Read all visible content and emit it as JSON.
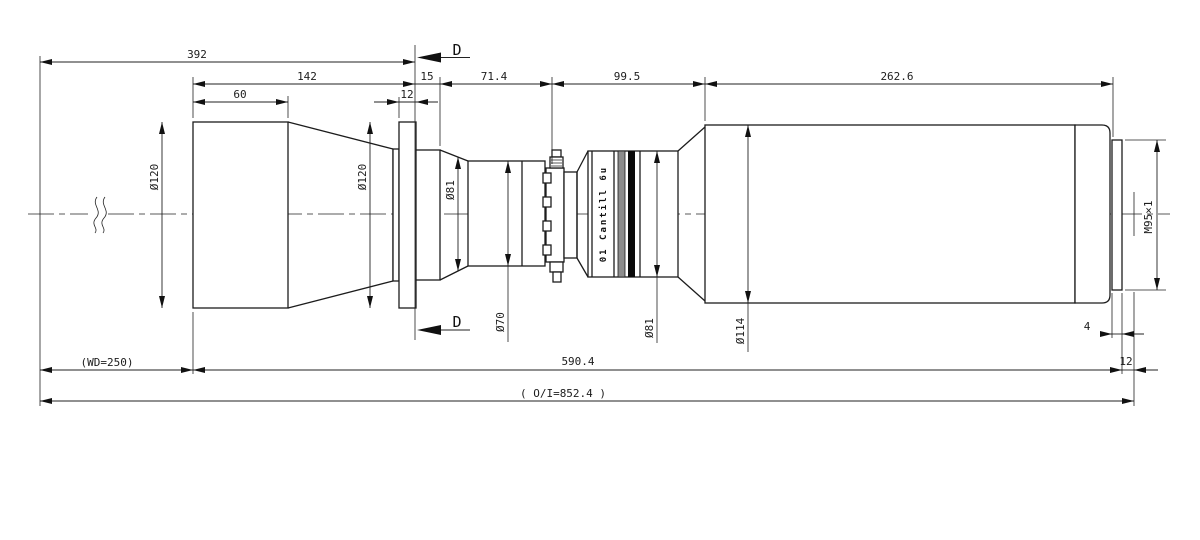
{
  "drawing": {
    "type": "technical-drawing",
    "subject": "lens mechanical outline drawing",
    "section_marker": "D",
    "dims_top": {
      "d392": "392",
      "d142": "142",
      "d60": "60",
      "d15": "15",
      "d12": "12",
      "d71_4": "71.4",
      "d99_5": "99.5",
      "d262_6": "262.6"
    },
    "dims_bottom": {
      "wd": "(WD=250)",
      "d590_4": "590.4",
      "d4": "4",
      "d12": "12",
      "oi": "( O/I=852.4 )"
    },
    "diameters": {
      "front": "Ø120",
      "flange": "Ø120",
      "cone81": "Ø81",
      "bore70": "Ø70",
      "barrel81": "Ø81",
      "main114": "Ø114"
    },
    "thread": "M95×1",
    "barrel_marking": "01 Cantill 6u",
    "colors": {
      "line": "#1c1c1c",
      "band_black": "#0a0a0a",
      "band_gray": "#8c8c8c"
    }
  }
}
